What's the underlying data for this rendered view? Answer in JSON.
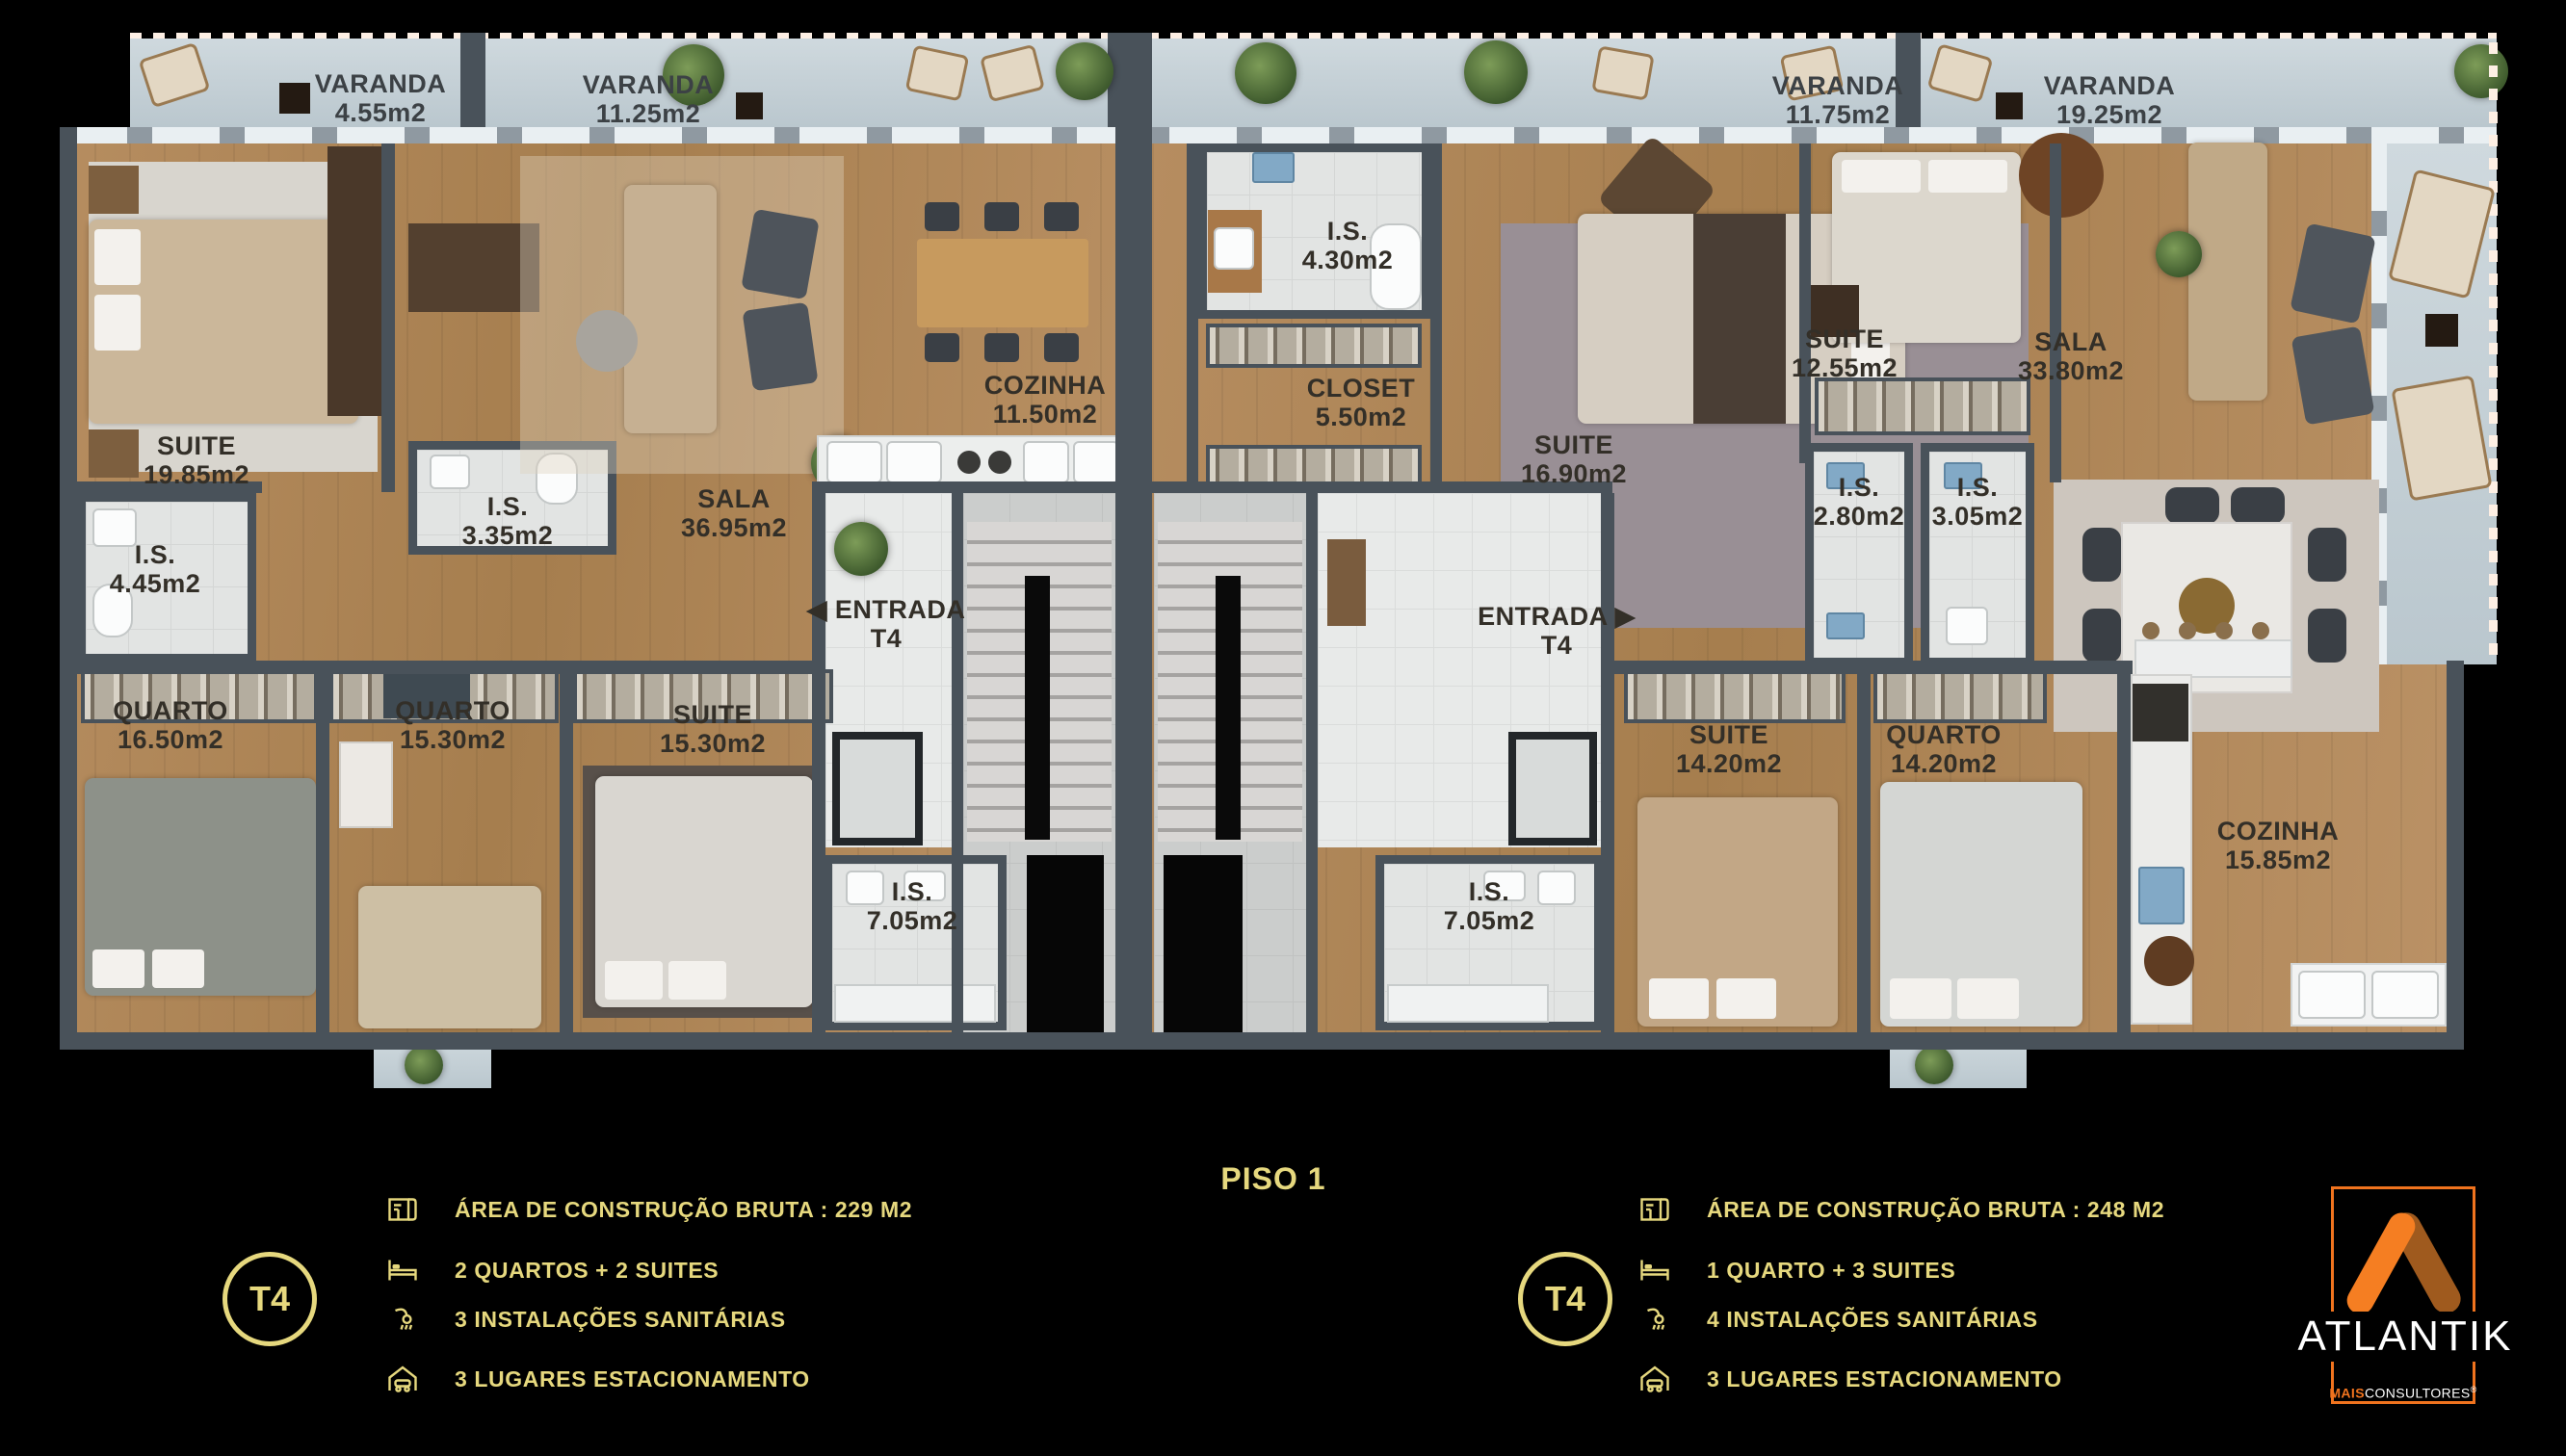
{
  "floor_title": "PISO 1",
  "labels": {
    "varanda_a": "VARANDA\n4.55m2",
    "varanda_b": "VARANDA\n11.25m2",
    "varanda_c": "VARANDA\n11.75m2",
    "varanda_d": "VARANDA\n19.25m2",
    "left_suite": "SUITE\n19.85m2",
    "left_is_suite": "I.S.\n4.45m2",
    "left_is_hall": "I.S.\n3.35m2",
    "left_sala": "SALA\n36.95m2",
    "left_cozinha": "COZINHA\n11.50m2",
    "left_entrada": "◀ ENTRADA\nT4",
    "left_quarto_1": "QUARTO\n16.50m2",
    "left_quarto_2": "QUARTO\n15.30m2",
    "left_suite_2": "SUITE\n15.30m2",
    "left_is_common": "I.S.\n7.05m2",
    "right_is_entry": "I.S.\n4.30m2",
    "right_closet": "CLOSET\n5.50m2",
    "right_suite_1": "SUITE\n16.90m2",
    "right_suite_2": "SUITE\n12.55m2",
    "right_is_1": "I.S.\n2.80m2",
    "right_is_2": "I.S.\n3.05m2",
    "right_sala": "SALA\n33.80m2",
    "right_entrada": "ENTRADA ▶\nT4",
    "right_suite_3": "SUITE\n14.20m2",
    "right_quarto": "QUARTO\n14.20m2",
    "right_cozinha": "COZINHA\n15.85m2",
    "right_is_common": "I.S.\n7.05m2"
  },
  "legend_left": {
    "badge": "T4",
    "items": [
      {
        "icon": "floorplan-icon",
        "text": "ÁREA DE CONSTRUÇÃO BRUTA :  229 M2"
      },
      {
        "icon": "bed-icon",
        "text": "2 QUARTOS + 2 SUITES"
      },
      {
        "icon": "shower-icon",
        "text": "3 INSTALAÇÕES SANITÁRIAS"
      },
      {
        "icon": "garage-icon",
        "text": "3 LUGARES ESTACIONAMENTO"
      }
    ]
  },
  "legend_right": {
    "badge": "T4",
    "items": [
      {
        "icon": "floorplan-icon",
        "text": "ÁREA DE CONSTRUÇÃO BRUTA :  248 M2"
      },
      {
        "icon": "bed-icon",
        "text": "1 QUARTO + 3 SUITES"
      },
      {
        "icon": "shower-icon",
        "text": "4 INSTALAÇÕES SANITÁRIAS"
      },
      {
        "icon": "garage-icon",
        "text": "3 LUGARES ESTACIONAMENTO"
      }
    ]
  },
  "brand": {
    "name": "ATLANTIK",
    "sub_prefix": "MAIS",
    "sub_suffix": "CONSULTORES",
    "trademark": "®"
  },
  "colors": {
    "gold": "#e6d87e",
    "brand_orange": "#f0731e",
    "brand_amber": "#9f5a1e",
    "wall": "#49525a",
    "wood_floor": "#b08457",
    "tile": "#e2e4e3",
    "balcony_concrete": "#c8d3d9",
    "background": "#000000"
  }
}
